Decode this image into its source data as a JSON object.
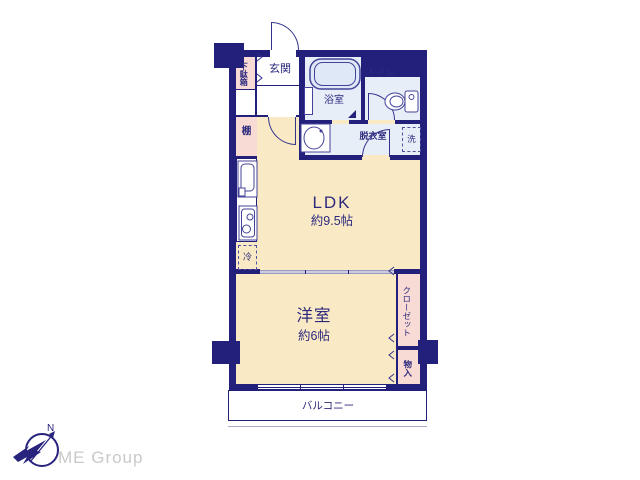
{
  "floor_plan": {
    "rooms": {
      "getabako": "下駄箱",
      "genkan": "玄関",
      "bath": "浴室",
      "toilet": "トイレ",
      "dressing": "脱衣室",
      "washer": "洗",
      "shelf": "棚",
      "fridge": "冷",
      "ldk": {
        "name": "LDK",
        "size": "約9.5帖"
      },
      "western": {
        "name": "洋室",
        "size": "約6帖"
      },
      "closet": "クローゼット",
      "storage": "物入",
      "balcony": "バルコニー"
    },
    "colors": {
      "wall": "#22207a",
      "room_cream": "#f9e9c5",
      "room_pink": "#f8dbd4",
      "room_wet": "#e8eef8",
      "text": "#2d2a7e",
      "sliding_door": "#ccccdc",
      "logo_text": "#c9c9c9"
    }
  },
  "logo": {
    "company": "ME Group",
    "north": "N"
  }
}
